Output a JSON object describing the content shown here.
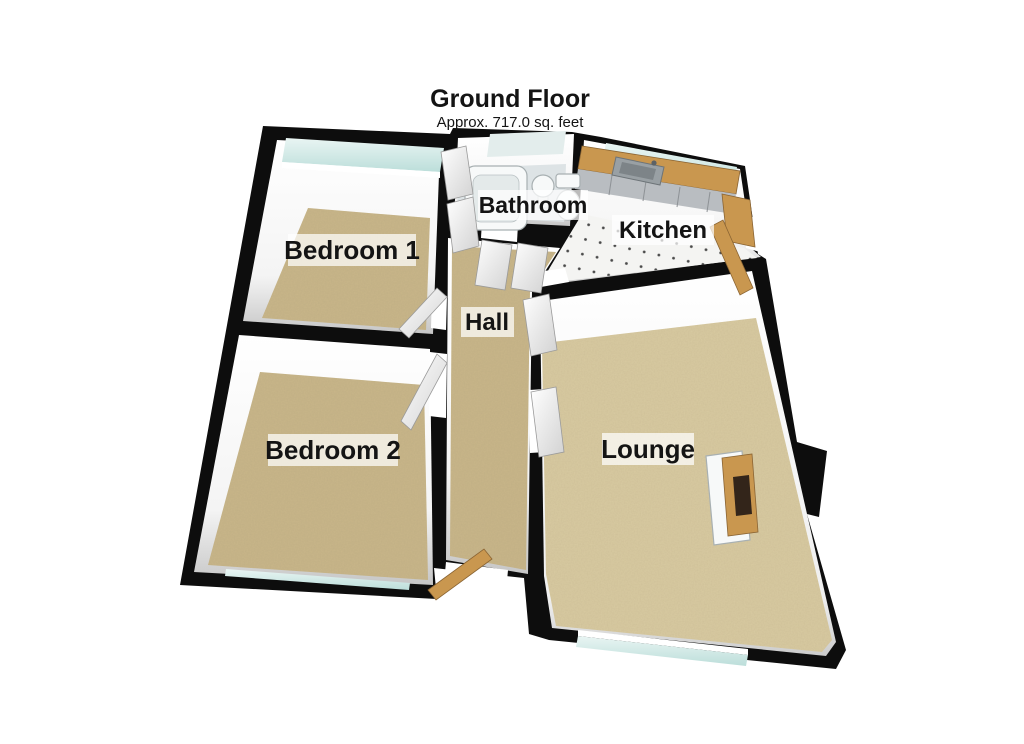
{
  "header": {
    "title": "Ground Floor",
    "subtitle": "Approx. 717.0 sq. feet"
  },
  "rooms": {
    "bedroom1": {
      "label": "Bedroom 1"
    },
    "bedroom2": {
      "label": "Bedroom 2"
    },
    "bathroom": {
      "label": "Bathroom"
    },
    "kitchen": {
      "label": "Kitchen"
    },
    "hall": {
      "label": "Hall"
    },
    "lounge": {
      "label": "Lounge"
    }
  },
  "colors": {
    "wall": "#0d0d0d",
    "carpet": "#c9b689",
    "lounge_carpet": "#d9cba2",
    "window_glass": "#cfe7e5",
    "frosted_glass": "#e3edec",
    "wood": "#c9974f",
    "cabinet": "#b9bdc1",
    "kitchen_floor": "#f4f4f2",
    "bathroom_floor": "#dde3e5",
    "door_leaf": "#f0f0f0"
  }
}
